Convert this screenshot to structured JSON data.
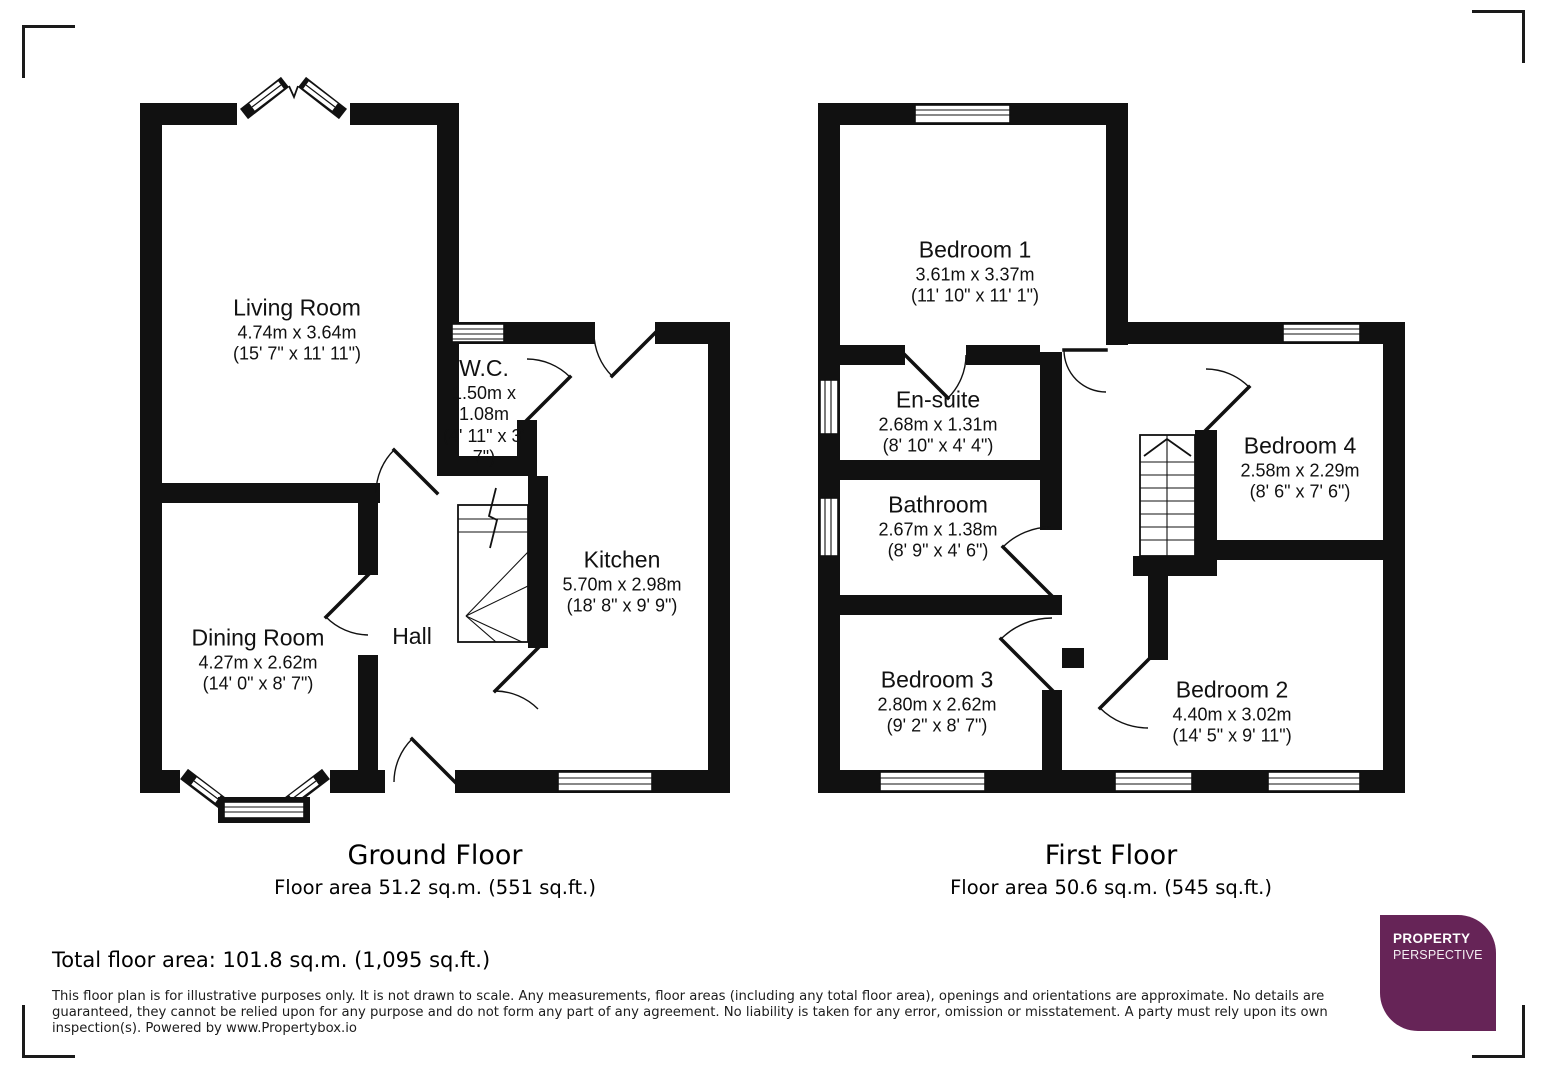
{
  "ground_floor": {
    "caption": "Ground Floor",
    "area": "Floor area 51.2 sq.m. (551 sq.ft.)",
    "rooms": {
      "living_room": {
        "name": "Living Room",
        "metric": "4.74m x 3.64m",
        "imperial": "(15' 7\" x 11' 11\")"
      },
      "wc": {
        "name": "W.C.",
        "metric": "1.50m x 1.08m",
        "imperial": "(4' 11\" x 3' 7\")"
      },
      "kitchen": {
        "name": "Kitchen",
        "metric": "5.70m x 2.98m",
        "imperial": "(18' 8\" x 9' 9\")"
      },
      "dining_room": {
        "name": "Dining Room",
        "metric": "4.27m x 2.62m",
        "imperial": "(14' 0\" x 8' 7\")"
      },
      "hall": {
        "name": "Hall"
      }
    }
  },
  "first_floor": {
    "caption": "First Floor",
    "area": "Floor area 50.6 sq.m. (545 sq.ft.)",
    "rooms": {
      "bedroom_1": {
        "name": "Bedroom 1",
        "metric": "3.61m x 3.37m",
        "imperial": "(11' 10\" x 11' 1\")"
      },
      "en_suite": {
        "name": "En-suite",
        "metric": "2.68m x 1.31m",
        "imperial": "(8' 10\" x 4' 4\")"
      },
      "bathroom": {
        "name": "Bathroom",
        "metric": "2.67m x 1.38m",
        "imperial": "(8' 9\" x 4' 6\")"
      },
      "bedroom_4": {
        "name": "Bedroom 4",
        "metric": "2.58m x 2.29m",
        "imperial": "(8' 6\" x 7' 6\")"
      },
      "bedroom_3": {
        "name": "Bedroom 3",
        "metric": "2.80m x 2.62m",
        "imperial": "(9' 2\" x 8' 7\")"
      },
      "bedroom_2": {
        "name": "Bedroom 2",
        "metric": "4.40m x 3.02m",
        "imperial": "(14' 5\" x 9' 11\")"
      }
    }
  },
  "footer": {
    "total_area": "Total floor area: 101.8 sq.m. (1,095 sq.ft.)",
    "disclaimer": "This floor plan is for illustrative purposes only. It is not drawn to scale. Any measurements, floor areas (including any total floor area), openings and orientations are approximate. No details are guaranteed, they cannot be relied upon for any purpose and do not form any part of any agreement. No liability is taken for any error, omission or misstatement. A party must rely upon its own inspection(s). Powered by www.Propertybox.io"
  },
  "logo": {
    "line1": "PROPERTY",
    "line2": "PERSPECTIVE",
    "color": "#662457"
  },
  "colors": {
    "wall_black": "#111111",
    "logo_purple": "#662457"
  }
}
